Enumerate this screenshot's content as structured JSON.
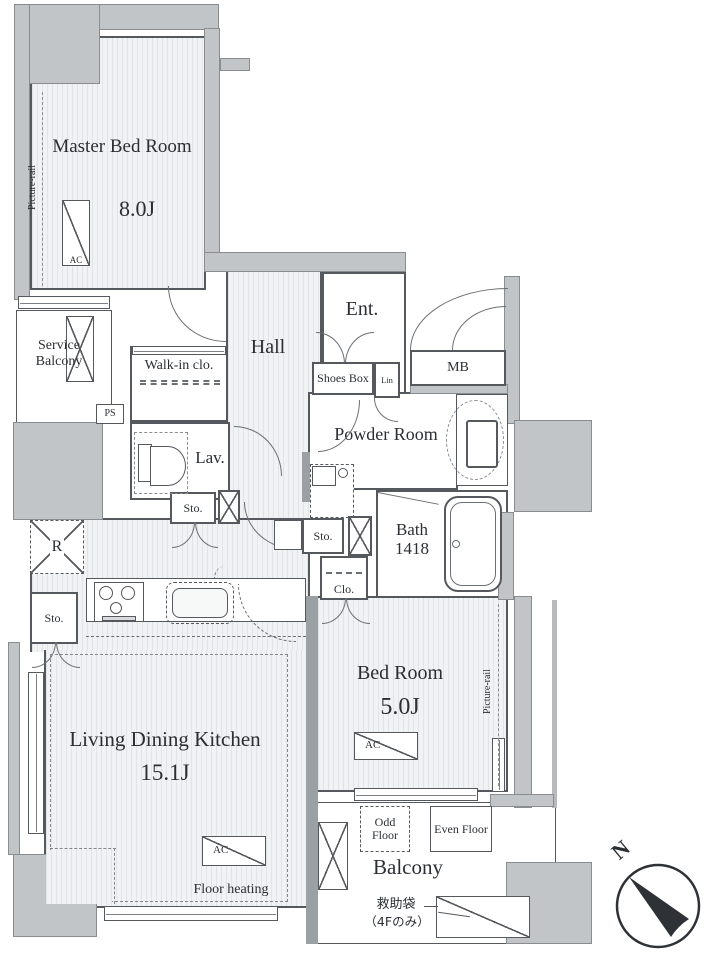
{
  "plan": {
    "rooms": {
      "master_bedroom": {
        "label": "Master Bed Room",
        "size": "8.0J"
      },
      "service_balcony": {
        "label": "Service Balcony"
      },
      "walk_in_closet": {
        "label": "Walk-in clo."
      },
      "hall": {
        "label": "Hall"
      },
      "lavatory": {
        "label": "Lav."
      },
      "entrance": {
        "label": "Ent."
      },
      "powder_room": {
        "label": "Powder Room"
      },
      "bathroom": {
        "label": "Bath",
        "size": "1418"
      },
      "bedroom": {
        "label": "Bed Room",
        "size": "5.0J"
      },
      "living_dining_kitchen": {
        "label": "Living Dining Kitchen",
        "size": "15.1J",
        "floor_heating": "Floor heating"
      },
      "balcony": {
        "label": "Balcony",
        "odd_floor": "Odd Floor",
        "even_floor": "Even Floor",
        "rescue_bag": "救助袋",
        "rescue_bag_note": "（4Fのみ）"
      }
    },
    "fixtures": {
      "ac": "AC",
      "picture_rail": "Picture-rail",
      "pipe_space": "PS",
      "refrigerator": "R",
      "storage": "Sto.",
      "closet": "Clo.",
      "shoes_box": "Shoes Box",
      "linen": "Lin",
      "meter_box": "MB"
    },
    "compass": {
      "north": "N"
    },
    "colors": {
      "wall_fill": "#c2c5c7",
      "line": "#55595d",
      "hatch": "#e2e5e7",
      "text": "#2b2f33"
    }
  }
}
